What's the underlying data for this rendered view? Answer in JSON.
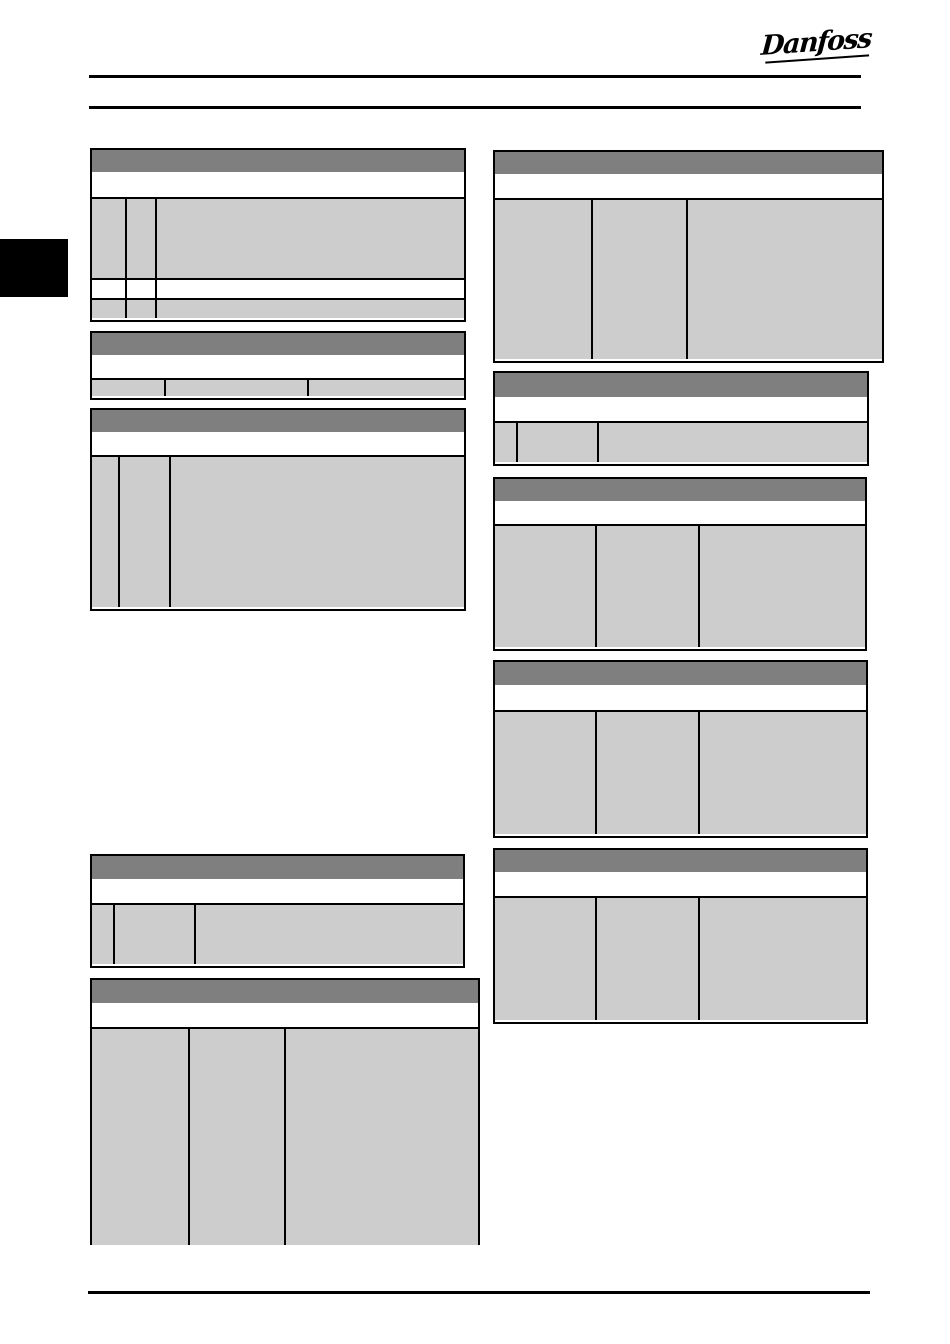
{
  "page": {
    "logo_text": "Danfoss",
    "colors": {
      "table_header_gray": "#7f7f7f",
      "table_cell_gray": "#cdcdcd",
      "line_black": "#000000",
      "page_background": "#ffffff"
    }
  },
  "tables": {
    "l1": {
      "header_text": "",
      "subheader_text": "",
      "rows": [
        {
          "cells": [
            "",
            "",
            ""
          ]
        },
        {
          "cells": [
            "",
            "",
            ""
          ]
        },
        {
          "cells": [
            "",
            "",
            ""
          ]
        }
      ]
    },
    "l2": {
      "header_text": "",
      "subheader_text": "",
      "rows": [
        {
          "cells": [
            "",
            "",
            ""
          ]
        }
      ]
    },
    "l3": {
      "header_text": "",
      "subheader_text": "",
      "rows": [
        {
          "cells": [
            "",
            "",
            ""
          ]
        }
      ]
    },
    "l4": {
      "header_text": "",
      "subheader_text": "",
      "rows": [
        {
          "cells": [
            "",
            "",
            ""
          ]
        }
      ]
    },
    "l5": {
      "header_text": "",
      "subheader_text": "",
      "rows": [
        {
          "cells": [
            "",
            "",
            ""
          ]
        }
      ]
    },
    "r1": {
      "header_text": "",
      "subheader_text": "",
      "rows": [
        {
          "cells": [
            "",
            "",
            ""
          ]
        }
      ]
    },
    "r2": {
      "header_text": "",
      "subheader_text": "",
      "rows": [
        {
          "cells": [
            "",
            "",
            ""
          ]
        }
      ]
    },
    "r3": {
      "header_text": "",
      "subheader_text": "",
      "rows": [
        {
          "cells": [
            "",
            "",
            ""
          ]
        }
      ]
    },
    "r4": {
      "header_text": "",
      "subheader_text": "",
      "rows": [
        {
          "cells": [
            "",
            "",
            ""
          ]
        }
      ]
    },
    "r5": {
      "header_text": "",
      "subheader_text": "",
      "rows": [
        {
          "cells": [
            "",
            "",
            ""
          ]
        }
      ]
    }
  }
}
